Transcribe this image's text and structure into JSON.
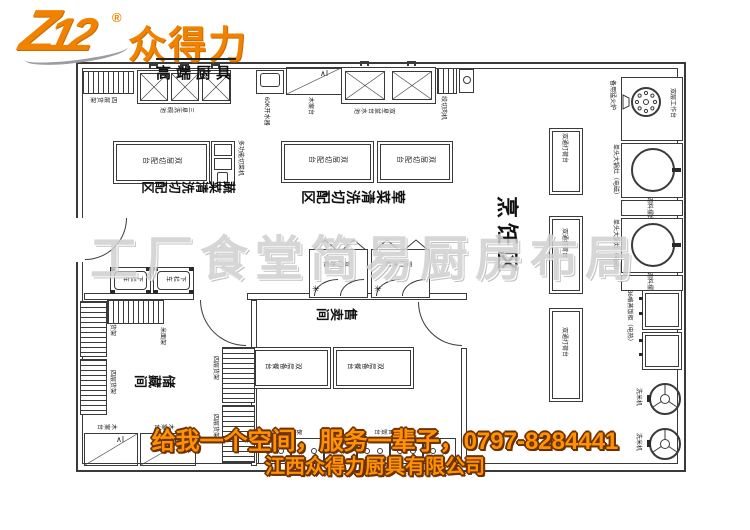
{
  "logo": {
    "mark": "Z12",
    "reg": "®",
    "name": "众得力",
    "tagline": "高端厨具"
  },
  "watermark": "工厂食堂简易厨房布局",
  "footer": {
    "slogan": "给我一个空间，服务一辈子，0797-8284441",
    "company": "江西众得力厨具有限公司"
  },
  "colors": {
    "brand": "#f08200",
    "footer_text": "#ff9102",
    "footer_outline": "#6d3200",
    "line": "#3a3a3a",
    "watermark": "#d0d0d0"
  },
  "zones": {
    "veg": "蔬菜清洗切配区",
    "meat": "荤菜清洗切配区",
    "cook": "烹饪区",
    "sales": "售卖间",
    "storage": "储藏间"
  },
  "equipment": {
    "shelf4": "四层货架",
    "sink3": "三星洗碗池",
    "boiler": "60K开水器",
    "woodtable": "木案台",
    "sink2": "双星盆台水池",
    "grinder": "绞切肉机",
    "sparestove": "备用猛火炉",
    "worktable2": "双层工作台",
    "bigstove": "单头大锅灶（电磁）",
    "spicetable": "调料摆台",
    "steamer": "36格蒸饭柜（电热）",
    "ricewasher": "洗米机",
    "dahe": "双通打荷台",
    "cuttable": "双层切配台",
    "vegcutter": "多功能切菜机",
    "cart": "下栏车",
    "fridge": "双门冰柜",
    "servetable": "双层备餐台",
    "servecounter": "保温售饭台",
    "riceshelf": "米面架"
  }
}
